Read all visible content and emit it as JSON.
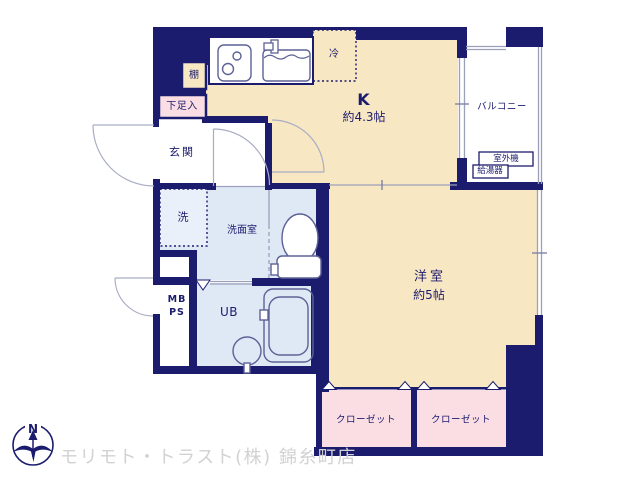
{
  "plan": {
    "rooms": {
      "kitchen": {
        "label": "K",
        "size": "約4.3帖"
      },
      "western_room": {
        "label": "洋室",
        "size": "約5帖"
      },
      "entrance": {
        "label": "玄関"
      },
      "shoe_storage": {
        "label": "下足入"
      },
      "shelf": {
        "label": "棚"
      },
      "refrigerator": {
        "label": "冷"
      },
      "washing_machine": {
        "label": "洗"
      },
      "washroom": {
        "label": "洗面室"
      },
      "meter_box": {
        "line1": "MB",
        "line2": "PS"
      },
      "unit_bath": {
        "label": "UB"
      },
      "balcony": {
        "label": "バルコニー"
      },
      "outdoor_unit": {
        "label": "室外機"
      },
      "water_heater": {
        "label": "給湯器"
      },
      "closet_left": {
        "label": "クローゼット"
      },
      "closet_right": {
        "label": "クローゼット"
      }
    },
    "compass": {
      "north": "N"
    },
    "footer": {
      "company": "モリモト・トラスト(株) 錦糸町店"
    },
    "colors": {
      "wall": "#1c1c6e",
      "room_beige": "#f8e7c3",
      "room_pink": "#fadee3",
      "room_blue": "#dfe9f5",
      "line_gray": "#9ba0bb",
      "watermark_gray": "#d2d2d2",
      "label_navy": "#1c1c6e"
    }
  }
}
